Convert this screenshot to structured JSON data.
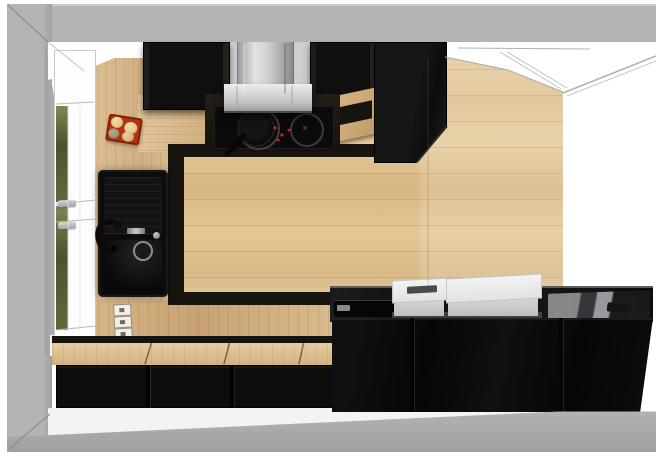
{
  "scene": {
    "description": "Top-down 3D render of a kitchen with black cabinets, oak wood floor and counters, window on the left and doorway at the top right",
    "view": "top-down-perspective",
    "room": "kitchen"
  },
  "palette": {
    "wall": "#b3b4b6",
    "wallDark": "#a0a0a2",
    "wallLight": "#cacbcd",
    "reveal": "#ffffff",
    "floorWood": "#e2c594",
    "counterWood": "#d9ba8c",
    "bandDark": "#17130f",
    "cabBlack": "#111010",
    "glossBlack": "#0a0a0c",
    "steelLight": "#e9e9e9",
    "steelDark": "#8a8a8a",
    "backsplash": "#cdced0",
    "trayRed": "#b23510",
    "trayRedDark": "#7e2208",
    "bun": "#e7c78e",
    "bunDark": "#9b8e77",
    "foliageLight": "#7c8a52",
    "foliage": "#49542c",
    "cooktopGlass": "#0b0b0d",
    "ringGray": "#414144",
    "indicatorRed": "#cf2318",
    "applWhite": "#f3f3f3",
    "applShadow": "#3f3f41",
    "floorStrip": "#f3f3f3",
    "sillWhite": "#f4f4f4"
  },
  "objects": {
    "floor": {
      "label": "oak plank floor"
    },
    "window": {
      "label": "window with garden view",
      "handles": 2
    },
    "door": {
      "label": "doorway opening"
    },
    "sink": {
      "label": "black granite sink with drainer",
      "bowls": 2
    },
    "faucet": {
      "label": "black kitchen faucet"
    },
    "cooktop": {
      "label": "black induction cooktop",
      "burners_visible": 2
    },
    "pan": {
      "label": "black frying pan"
    },
    "hood": {
      "label": "stainless steel chimney hood"
    },
    "tray": {
      "label": "red tray with bread rolls",
      "rolls": 4
    },
    "outlets": {
      "label": "triple socket strip",
      "count": 3
    },
    "appliances": {
      "label": "white countertop appliance"
    },
    "glass_board": {
      "label": "glass cutting board"
    },
    "wall_cabinets": {
      "label": "black wall cabinet"
    },
    "tall_unit": {
      "label": "tall black cabinet unit"
    },
    "bench": {
      "label": "black bench cabinets with wood top"
    },
    "island": {
      "label": "black gloss island counter"
    },
    "shelf": {
      "label": "wood open shelf niche"
    }
  }
}
